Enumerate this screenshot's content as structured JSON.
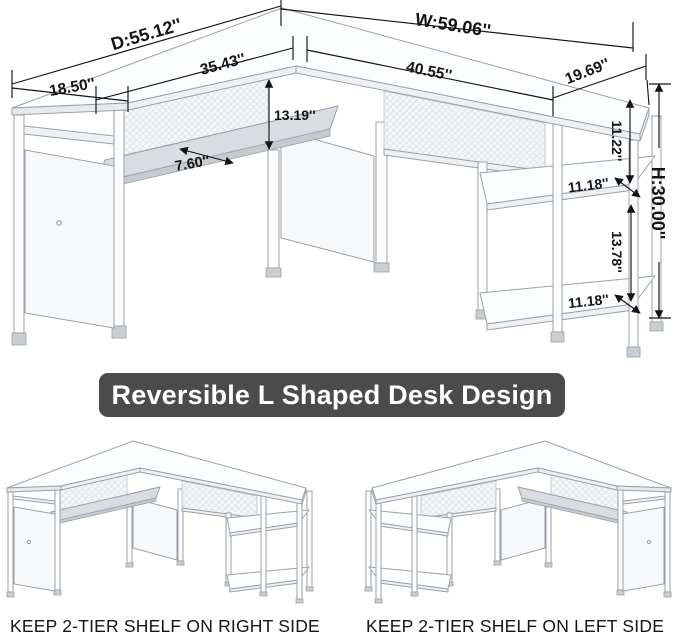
{
  "banner": {
    "label": "Reversible L Shaped Desk Design",
    "bg_color": "#4b4b4b",
    "text_color": "#ffffff"
  },
  "dims": {
    "overall_depth": "D:55.12''",
    "overall_width": "W:59.06''",
    "left_top_length": "35.43''",
    "right_top_length": "40.55''",
    "left_top_depth": "18.50''",
    "right_top_depth": "19.69''",
    "desktop_to_tray": "13.19''",
    "tray_depth": "7.60''",
    "upper_shelf_clearance": "11.22''",
    "upper_shelf_depth": "11.18''",
    "lower_shelf_clearance": "13.78''",
    "lower_shelf_depth": "11.18''",
    "overall_height": "H:30.00''"
  },
  "variants": {
    "left_caption": "KEEP 2-TIER SHELF ON RIGHT SIDE",
    "right_caption": "KEEP 2-TIER SHELF ON LEFT SIDE"
  },
  "colors": {
    "dimension_lines": "#141414",
    "desk_outline": "#9aa1a8",
    "background": "#ffffff"
  }
}
